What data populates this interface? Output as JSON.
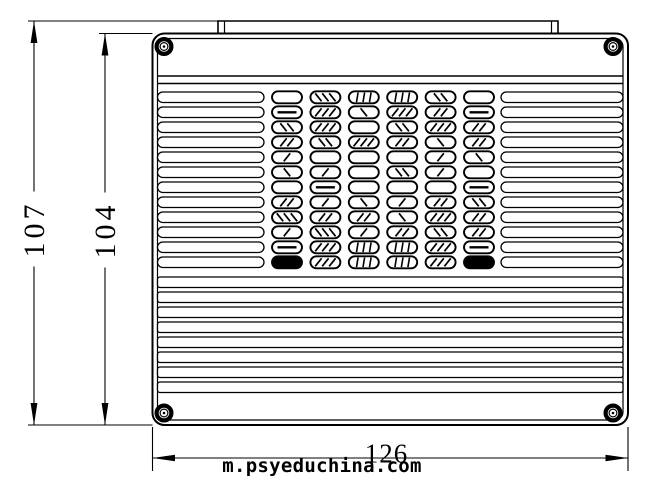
{
  "drawing": {
    "description": "engineering line drawing, top view of vented enclosure cover with corner screws",
    "background": "#ffffff",
    "line_color": "#000000",
    "dimensions": [
      {
        "name": "overall-height",
        "value": "107",
        "orientation": "vertical"
      },
      {
        "name": "body-height",
        "value": "104",
        "orientation": "vertical"
      },
      {
        "name": "overall-width",
        "value": "126",
        "orientation": "horizontal"
      }
    ],
    "watermark": "m.psyeduchina.com",
    "grille": {
      "side_slat_rows": 12,
      "full_width_slat_rows": 8,
      "oval_rows": 12,
      "oval_cols": 6,
      "pattern": [
        [
          "e",
          "d3",
          "v3",
          "v3",
          "d2",
          "e"
        ],
        [
          "h",
          "d3",
          "d1",
          "d3",
          "d2",
          "h"
        ],
        [
          "d2",
          "d3",
          "e",
          "d2",
          "d3",
          "d2"
        ],
        [
          "d2",
          "d2",
          "d3",
          "d2",
          "d1",
          "d2"
        ],
        [
          "d1",
          "e",
          "e",
          "e",
          "d1",
          "d1"
        ],
        [
          "d1",
          "d1",
          "e",
          "d2",
          "d1",
          "e"
        ],
        [
          "e",
          "h",
          "e",
          "e",
          "e",
          "h"
        ],
        [
          "d2",
          "d1",
          "d1",
          "d1",
          "d2",
          "d2"
        ],
        [
          "d3",
          "d2",
          "d2",
          "d1",
          "d3",
          "d2"
        ],
        [
          "d1",
          "d3",
          "d1",
          "d2",
          "d2",
          "d2"
        ],
        [
          "h",
          "d3",
          "v3",
          "v3",
          "d3",
          "h"
        ],
        [
          "s",
          "d3",
          "v3",
          "v3",
          "d3",
          "s"
        ]
      ]
    },
    "corner_screws": 4
  }
}
